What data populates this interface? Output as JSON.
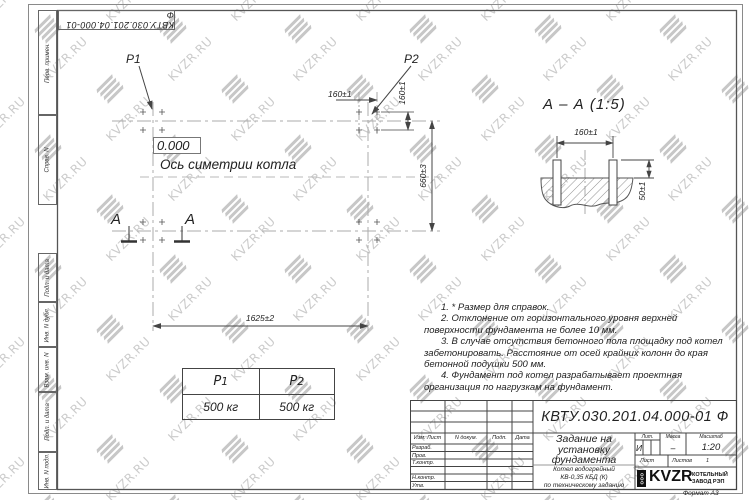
{
  "sheet": {
    "stamp_top": "КВТУ.030.201.04.000-01 Ф",
    "format_label": "Формат А3"
  },
  "margin_labels": {
    "perv_primen": "Перв. примен.",
    "sprav_n": "Справ. N",
    "podp_data_1": "Подп. и дата",
    "inv_dubl": "Инв. N дубл.",
    "vzam_inv": "Взам. инв. N",
    "podp_data_2": "Подп. и дата",
    "inv_podl": "Инв. N подл."
  },
  "plan": {
    "p1": "P1",
    "p2": "P2",
    "level": "0.000",
    "axis": "Ось симетрии котла",
    "dim_group_h": "160±1",
    "dim_group_v": "160±1",
    "dim_width": "660±3",
    "dim_length": "1625±2",
    "cut_letter": "A"
  },
  "section": {
    "title": "А – А (1:5)",
    "dim_bolts": "160±1",
    "dim_height": "50±1"
  },
  "notes": [
    "1. * Размер для справок.",
    "2. Отклонение от горизонтального уровня верхней поверхности фундамента не более 10 мм.",
    "3. В случае отсутствия бетонного пола площадку под котел забетонировать. Расстояние от осей крайних колонн до края бетонной подушки 500 мм.",
    "4. Фундамент под котел разрабатывает проектная организация по нагрузкам на фундамент."
  ],
  "loads": {
    "base": "P",
    "subs": [
      "1",
      "2"
    ],
    "values": [
      "500 кг",
      "500 кг"
    ]
  },
  "title_block": {
    "doc_number": "КВТУ.030.201.04.000-01 Ф",
    "title_lines": [
      "Задание на",
      "установку",
      "фундамента"
    ],
    "product_lines": [
      "Котел водогрейный",
      "КВ-0,35 КБД (К)",
      "по техническому заданию"
    ],
    "sig_header": [
      "Изм. Лист",
      "N докум.",
      "Подп.",
      "Дата"
    ],
    "sig_rows": [
      "Разраб.",
      "Пров.",
      "Т.контр.",
      "",
      "Н.контр.",
      "Утв."
    ],
    "lit_label": "Лит.",
    "mass_label": "Масса",
    "scale_label": "Масштаб",
    "lit_value": "И",
    "mass_value": "–",
    "scale_value": "1:20",
    "sheet_label": "Лист",
    "sheets_label": "Листов",
    "sheets_value": "1",
    "company": {
      "ooo": "ООО",
      "brand": "KVZR",
      "line1": "КОТЕЛЬНЫЙ",
      "line2": "ЗАВОД РЭП"
    }
  },
  "watermark": {
    "text": "KVZR.RU",
    "color": "#cbcbcb"
  }
}
